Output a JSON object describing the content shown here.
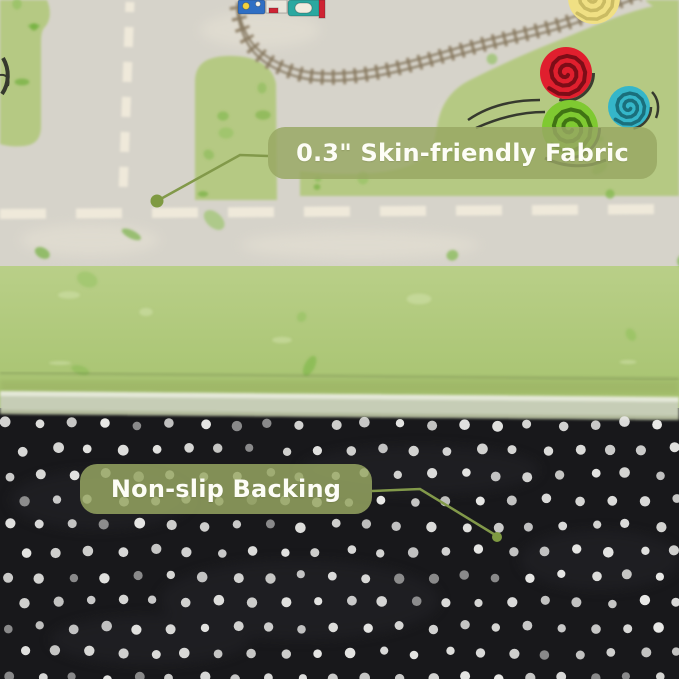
{
  "product_image": {
    "subject": "kids road-map play rug folded over to reveal its underside",
    "annotations": [
      {
        "id": "fabric",
        "label": "0.3\" Skin-friendly Fabric"
      },
      {
        "id": "backing",
        "label": "Non-slip Backing"
      }
    ],
    "colors": {
      "callout_bg": "rgba(152,167,99,0.83)",
      "callout_text": "#fdfdf6",
      "leader_line": "#82994a",
      "anchor_dot": "#7f9a42",
      "rug_road": "#d6d3ca",
      "road_marking": "#efe9da",
      "rug_grass": "#b5c983",
      "grass_speckle": "#6fae3a",
      "rug_border_green_top": "#b9cf88",
      "rug_border_green_bottom": "#a5c26d",
      "mesh_edge": "#c6cdb6",
      "backing_black": "#18181b",
      "backing_dot": "#e8e8e6",
      "railroad_brown": "#8a7a60",
      "train_teal": "#2aa8a0",
      "train_blue": "#2f6fc4",
      "train_red": "#cf2333",
      "tree_red": "#e01f2e",
      "tree_green": "#7fc931",
      "tree_teal": "#35b6c9",
      "tree_yellow": "#f0e084"
    }
  }
}
